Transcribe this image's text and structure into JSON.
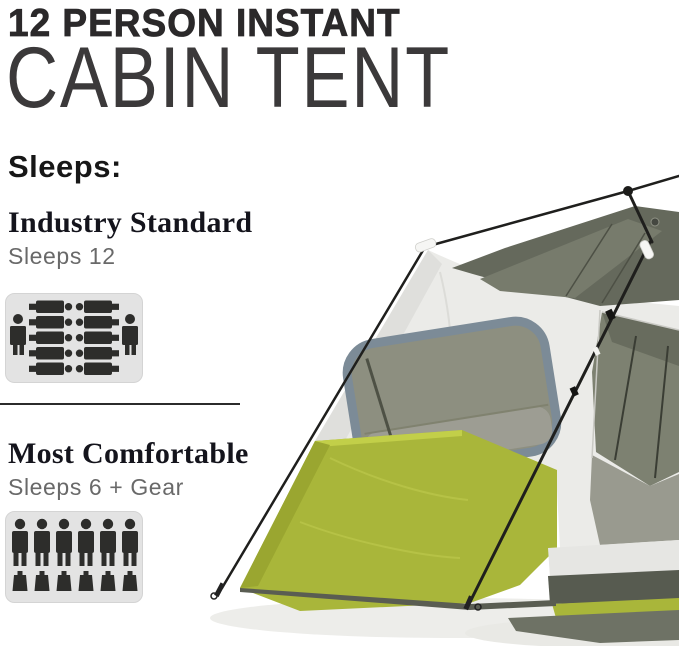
{
  "header": {
    "title_line1": "12 PERSON INSTANT",
    "title_line2": "CABIN TENT"
  },
  "sleeps": {
    "heading": "Sleeps:",
    "industry_standard": {
      "title": "Industry Standard",
      "subtitle": "Sleeps 12",
      "capacity": 12,
      "icon": "sleeps-12-occupancy-icon",
      "icon_figures": {
        "sleeping_bags": 10,
        "standing_people": 2
      }
    },
    "most_comfortable": {
      "title": "Most Comfortable",
      "subtitle": "Sleeps 6 + Gear",
      "capacity": 6,
      "icon": "sleeps-6-gear-icon",
      "icon_figures": {
        "standing_people": 6,
        "gear_bags": 6
      }
    }
  },
  "photo": {
    "subject": "12 person instant cabin tent with poles and guy lines",
    "colors": {
      "canopy_white": "#ebebe8",
      "roof_mesh_gray": "#65695c",
      "base_lime_green": "#a9b63a",
      "window_trim_blue_gray": "#7c8b97",
      "window_mesh_olive": "#8d8f80",
      "pole_black": "#1f1f1d",
      "icon_panel_gray": "#e3e3e3",
      "icon_figure_dark": "#2d2d2b"
    }
  }
}
